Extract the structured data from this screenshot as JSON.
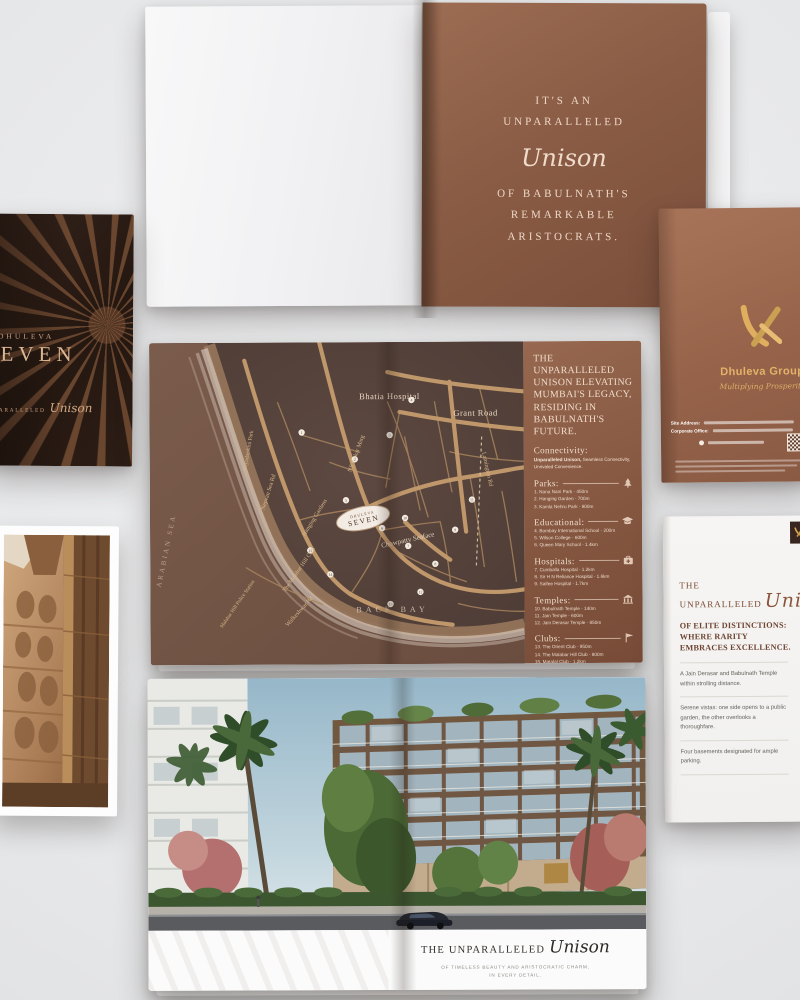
{
  "colors": {
    "copper": "#8a5a43",
    "gold": "#d9a84e",
    "cover_dark": "#271a14",
    "map_bg": "#54413b",
    "road": "#c49a6d",
    "cream": "#ecd6c3",
    "page_bg": "#ecedee"
  },
  "top_spread": {
    "right_page": {
      "line1": "IT'S AN",
      "line2": "UNPARALLELED",
      "script_word": "Unison",
      "line3": "OF BABULNATH'S",
      "line4": "REMARKABLE",
      "line5": "ARISTOCRATS."
    }
  },
  "front_cover": {
    "brand": "DHULEVA",
    "title": "SEVEN",
    "tagline_prefix": "UNPARALLELED",
    "tagline_script": "Unison"
  },
  "back_cover": {
    "brand": "Dhuleva Group",
    "tagline": "Multiplying Prosperity",
    "site_label": "Site Address:",
    "office_label": "Corporate Office:"
  },
  "map": {
    "labels": {
      "bhatia": "Bhatia Hospital",
      "grant": "Grant Road",
      "chowpatty": "Chowpatty Seaface",
      "lamington": "Lamington Rd",
      "patkar": "NS Patkar Marg",
      "nepean": "Nepean Sea Rd",
      "priyadarshini": "Priyadarshini Park",
      "hanging": "Hanging Gardens",
      "malabar_club": "The Malabar Hill Club",
      "police": "Malabar Hill Police Station",
      "walkeshwar": "Walkeshwar Rd",
      "sea": "ARABIAN SEA",
      "bay": "BACK BAY"
    },
    "badge": {
      "line1": "DHULEVA",
      "line2": "SEVEN"
    },
    "markers": [
      "1",
      "2",
      "3",
      "4",
      "5",
      "6",
      "7",
      "8",
      "9",
      "10",
      "11",
      "12",
      "13",
      "14",
      "15"
    ]
  },
  "map_panel": {
    "headline": "THE UNPARALLELED UNISON ELEVATING MUMBAI'S LEGACY, RESIDING IN BABULNATH'S FUTURE.",
    "connectivity": {
      "title": "Connectivity:",
      "bold": "Unparalleled Unison,",
      "rest": "Seamless Connectivity, Unrivaled Convenience."
    },
    "sections": [
      {
        "title": "Parks:",
        "icon": "tree-icon",
        "items": [
          "1. Nana Nani Park - 450m",
          "2. Hanging Garden - 700m",
          "3. Kamla Nehru Park - 800m"
        ]
      },
      {
        "title": "Educational:",
        "icon": "graduation-cap-icon",
        "items": [
          "4. Bombay International School - 200m",
          "5. Wilson College - 600m",
          "6. Queen Mary School - 1.4km"
        ]
      },
      {
        "title": "Hospitals:",
        "icon": "medical-bag-icon",
        "items": [
          "7. Cumballa Hospital - 1.2km",
          "8. Sir H N Reliance Hospital - 1.6km",
          "9. Saifee Hospital - 1.7km"
        ]
      },
      {
        "title": "Temples:",
        "icon": "temple-icon",
        "items": [
          "10. Babulnath Temple - 140m",
          "11. Jain Temple - 600m",
          "12. Jain Derasar Temple - 850m"
        ]
      },
      {
        "title": "Clubs:",
        "icon": "flag-icon",
        "items": [
          "13. The Orient Club - 950m",
          "14. The Malabar Hill Club - 800m",
          "15. Matalal Club - 1.2km"
        ]
      }
    ]
  },
  "elite_page": {
    "heading_line1": "THE",
    "heading_line2": "UNPARALLELED",
    "heading_script": "Unison",
    "subheading": "OF ELITE DISTINCTIONS: WHERE RARITY EMBRACES EXCELLENCE.",
    "paragraphs": [
      "A Jain Derasar and Babulnath Temple within strolling distance.",
      "Serene vistas: one side opens to a public garden, the other overlooks a thoroughfare.",
      "Four basements designated for ample parking."
    ]
  },
  "bottom_spread": {
    "footer_prefix": "THE UNPARALLELED",
    "footer_script": "Unison",
    "footer_line1": "OF TIMELESS BEAUTY AND ARISTOCRATIC CHARM,",
    "footer_line2": "IN EVERY DETAIL."
  }
}
